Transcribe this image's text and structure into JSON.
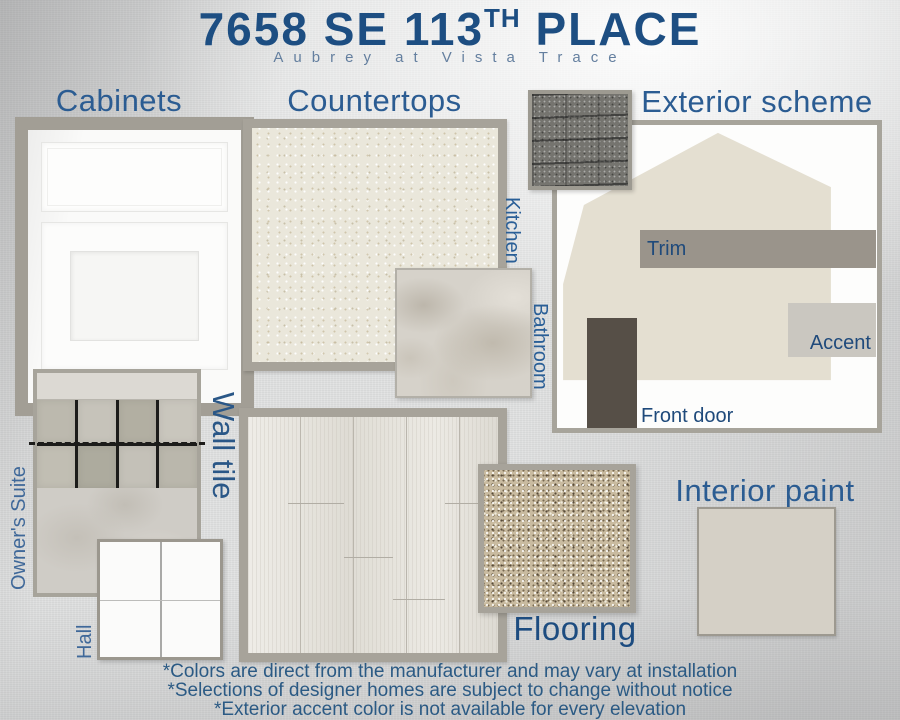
{
  "header": {
    "address_main": "7658 SE 113",
    "address_sup": "TH",
    "address_tail": "PLACE",
    "subtitle": "Aubrey at Vista Trace"
  },
  "sections": {
    "cabinets": {
      "title": "Cabinets"
    },
    "countertops": {
      "title": "Countertops",
      "labels": {
        "kitchen": "Kitchen",
        "bathroom": "Bathroom"
      }
    },
    "exterior": {
      "title": "Exterior scheme",
      "labels": {
        "trim": "Trim",
        "accent": "Accent",
        "front_door": "Front door"
      }
    },
    "wall_tile": {
      "title": "Wall tile",
      "labels": {
        "owners_suite": "Owner's Suite",
        "hall": "Hall"
      }
    },
    "flooring": {
      "title": "Flooring"
    },
    "interior_paint": {
      "title": "Interior paint"
    }
  },
  "footnotes": [
    "*Colors are direct from the manufacturer and may vary at installation",
    "*Selections of designer homes are subject to change without notice",
    "*Exterior accent color is not available for every elevation"
  ],
  "colors": {
    "title_blue": "#1d4e82",
    "heading_blue": "#2b5c92",
    "label_blue": "#1f4a7b",
    "frame_gray": "#a7a39a",
    "house_beige": "#e4dfd1",
    "trim": "#9a948b",
    "accent": "#cac7c0",
    "front_door": "#564f47",
    "interior_paint": "#d5d0c6"
  }
}
